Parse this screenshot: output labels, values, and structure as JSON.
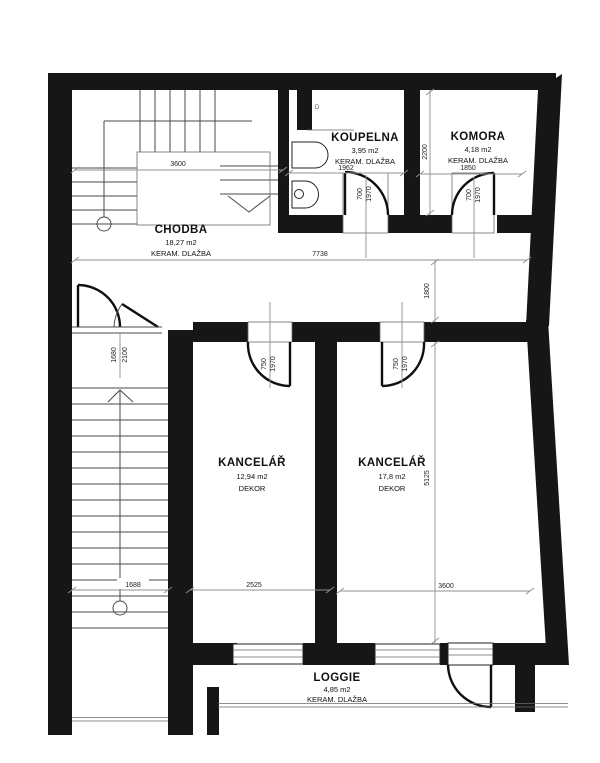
{
  "rooms": {
    "chodba": {
      "name": "CHODBA",
      "area": "18,27 m2",
      "floor": "KERAM. DLAŽBA"
    },
    "koupelna": {
      "name": "KOUPELNA",
      "area": "3,95 m2",
      "floor": "KERAM. DLAŽBA"
    },
    "komora": {
      "name": "KOMORA",
      "area": "4,18 m2",
      "floor": "KERAM. DLAŽBA"
    },
    "kancelar_left": {
      "name": "KANCELÁŘ",
      "area": "12,94 m2",
      "floor": "DEKOR"
    },
    "kancelar_right": {
      "name": "KANCELÁŘ",
      "area": "17,8 m2",
      "floor": "DEKOR"
    },
    "loggie": {
      "name": "LOGGIE",
      "area": "4,85 m2",
      "floor": "KERAM. DLAŽBA"
    }
  },
  "dims": {
    "stair_top_width": "3600",
    "hall_width": "7738",
    "koupelna_width": "1962",
    "komora_width": "1850",
    "komora_depth": "2200",
    "hall_right_depth": "1800",
    "offices_depth": "5125",
    "office_left_width": "2525",
    "office_right_width": "3600",
    "stairs_width": "1688",
    "entry_door_width": "1680",
    "entry_door_height": "2100",
    "bath_door_w": "700",
    "bath_door_h": "1970",
    "komora_door_w": "700",
    "komora_door_h": "1970",
    "office_left_door_w": "750",
    "office_left_door_h": "1970",
    "office_right_door_w": "750",
    "office_right_door_h": "1970",
    "marker_d": "D"
  }
}
